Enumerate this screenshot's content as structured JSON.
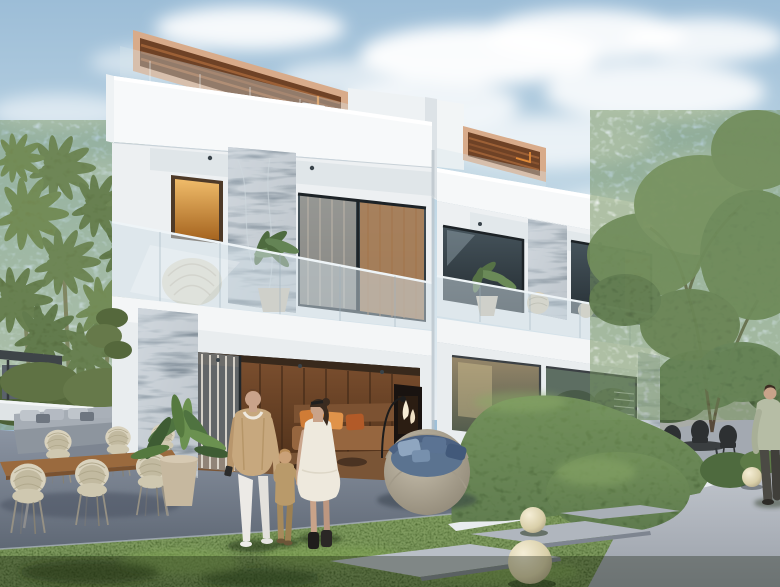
{
  "scene": {
    "title": "Modern twin villa exterior rendering",
    "description": "Photorealistic architectural rendering of a modern two-storey white twin villa with rooftop wood pergolas, grey marble-clad pillars, an amber-lit window, glass balcony railings, an open living room with orange cushions, palm trees on the left, leafy trees on the right, outdoor wicker dining set, round lounge chair with blue pillows, sculpted hedge, sphere garden lamps, stepping-stone paths, and a family of three walking hand in hand across the lawn.",
    "objects": [
      "sky",
      "clouds",
      "palm-trees",
      "right-trees",
      "villa-left-unit",
      "villa-right-unit",
      "rooftop-pergola",
      "roof-glass-railing",
      "marble-pillar",
      "amber-window",
      "balcony-glass-railing",
      "balcony-plant",
      "wicker-chair",
      "living-room-interior",
      "fireplace",
      "arc-lamp",
      "outdoor-dining-table",
      "wicker-dining-chairs",
      "outdoor-sectional-sofa",
      "potted-plant",
      "round-lounge-chair",
      "garden-hedge",
      "hedge-curb",
      "garden-path",
      "stepping-stones",
      "sphere-lamps",
      "lawn",
      "patio",
      "father",
      "child",
      "mother",
      "passerby",
      "back-patio-chairs",
      "stone-fence",
      "garden-pavilion"
    ]
  },
  "palette": {
    "sky-top": "#9fc0d8",
    "sky-bot": "#e7eef2",
    "cloud": "#ffffff",
    "building-white": "#f6f8f9",
    "building-shadow": "#d8dee3",
    "pergola-frame": "#d8ab8a",
    "pergola-wood": "#6e4226",
    "pergola-slat": "#9c6036",
    "accent-orange": "#e08a38",
    "marble-light": "#8795a2",
    "marble-dark": "#5f6d7a",
    "amber-light": "#eab05c",
    "amber-dark": "#9e5f22",
    "glass-dark": "#2c363c",
    "glass-railing": "#cfdde6",
    "curtain-warm": "#b98a5e",
    "curtain-sheer": "#d9d0c3",
    "interior-wood": "#6b4328",
    "sofa-orange": "#d07c36",
    "sofa-rust": "#b25a28",
    "palm-green": "#66794a",
    "palm-dark": "#4f6238",
    "tree-green": "#6d8656",
    "hedge-green": "#5d7a47",
    "grass-light": "#6f9448",
    "grass-mid": "#47632f",
    "grass-dark": "#2f4a22",
    "patio-gray": "#7d8694",
    "path-light": "#b6bcc3",
    "curb-white": "#e8ecee",
    "wicker-cream": "#d9d2bd",
    "table-wood": "#9a6a3e",
    "outdoor-sofa-gray": "#9aa2aa",
    "papasan-base": "#b3ab9b",
    "papasan-cushion": "#5b7390",
    "sphere-lamp": "#e9e0bd",
    "skin": "#c9a38a",
    "man-jacket": "#c7a87e",
    "man-pants": "#eceae6",
    "woman-dress": "#eee9dd",
    "child-outfit": "#b99a6a",
    "hair-dark": "#3a2b20",
    "boots-black": "#1f1d1b",
    "shirt-sage": "#b6bda5"
  }
}
